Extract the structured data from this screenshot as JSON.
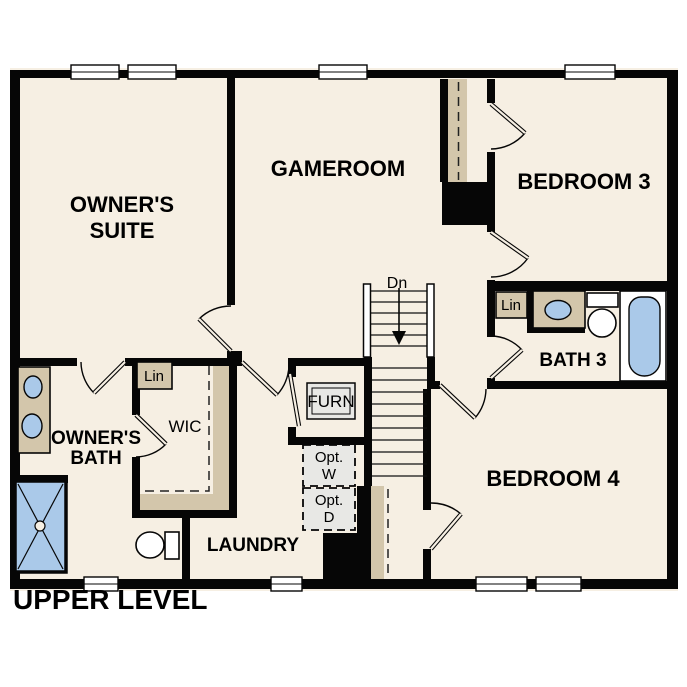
{
  "title": "UPPER LEVEL",
  "colors": {
    "floor": "#f6efe3",
    "wall": "#060606",
    "counter_tan": "#d3c6ab",
    "fixture_blue": "#aac9e9",
    "option_gray": "#e8e8e5",
    "text": "#000000"
  },
  "labels": {
    "owners_suite_1": "OWNER'S",
    "owners_suite_2": "SUITE",
    "gameroom": "GAMEROOM",
    "bedroom3": "BEDROOM 3",
    "bath3": "BATH 3",
    "bedroom4": "BEDROOM 4",
    "owners_bath_1": "OWNER'S",
    "owners_bath_2": "BATH",
    "wic": "WIC",
    "laundry": "LAUNDRY",
    "furnace": "FURN",
    "linen_wic": "Lin",
    "linen_bath3": "Lin",
    "stairs_down": "Dn",
    "opt_washer_1": "Opt.",
    "opt_washer_2": "W",
    "opt_dryer_1": "Opt.",
    "opt_dryer_2": "D"
  }
}
